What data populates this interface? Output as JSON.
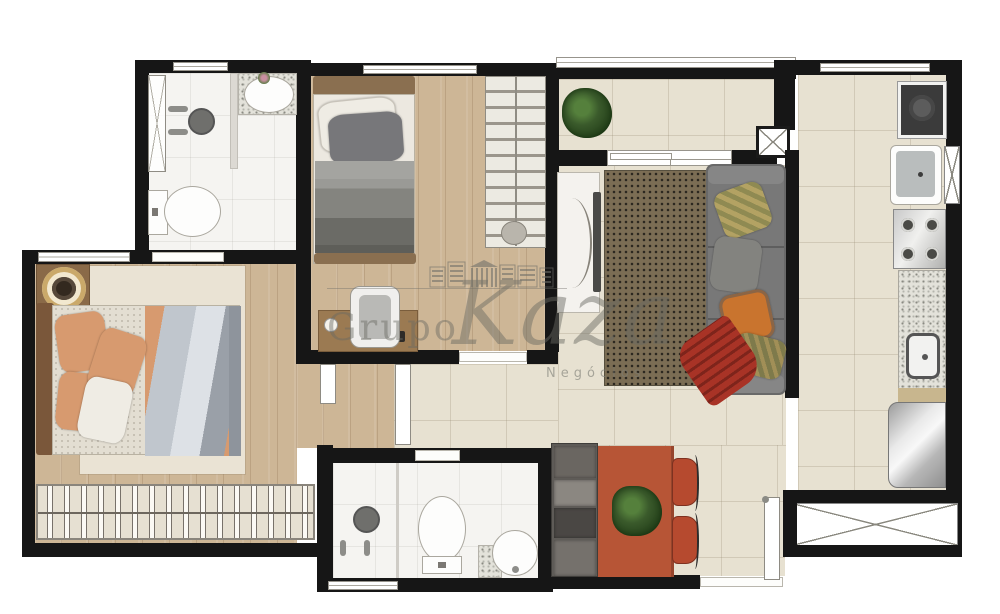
{
  "watermark": {
    "brand_top": "Grupo",
    "brand_main": "Kaza",
    "subtitle": "Negócios"
  },
  "colors": {
    "wall": "#161616",
    "wood": "#cdb696",
    "tile": "#e7e1d1",
    "bath": "#f5f4f1",
    "rugbed": "#eae3d4",
    "ruglive": "#7b6d54",
    "sofa": "#787878",
    "table": "#b75536",
    "chair": "#b64a2f",
    "bench": "#5e5b57",
    "plant": "#3a5a2b",
    "peach": "#d79a6f",
    "pillORG": "#c9742e",
    "throw_red": "#a83326",
    "watermark_gray": "#6e6e68"
  },
  "rooms": [
    {
      "name": "suite-bathroom",
      "furniture": [
        "shower-glass",
        "shower-head",
        "shower-faucets",
        "vanity-sink",
        "toilet"
      ]
    },
    {
      "name": "master-bedroom",
      "furniture": [
        "nightstand",
        "round-lamp",
        "double-bed",
        "area-rug",
        "wardrobe-hangers",
        "top-window"
      ]
    },
    {
      "name": "second-bedroom",
      "furniture": [
        "single-bed",
        "shelf-closet",
        "desk",
        "desk-chair",
        "top-window"
      ]
    },
    {
      "name": "hallway",
      "furniture": [
        "door-leaf-master",
        "door-leaf-bathroom"
      ]
    },
    {
      "name": "social-bathroom",
      "furniture": [
        "shower-head",
        "shower-faucets",
        "toilet",
        "round-sink",
        "bottom-window"
      ]
    },
    {
      "name": "balcony",
      "furniture": [
        "railing",
        "potted-plant",
        "sliding-door"
      ]
    },
    {
      "name": "living-room",
      "furniture": [
        "tv-panel",
        "tv",
        "dotted-rug",
        "sofa",
        "throw-pillows",
        "red-throw"
      ]
    },
    {
      "name": "dining-area",
      "furniture": [
        "bench",
        "dining-table",
        "table-plant",
        "chair",
        "chair",
        "entry-door"
      ]
    },
    {
      "name": "kitchen-laundry",
      "furniture": [
        "washing-machine",
        "laundry-tank",
        "cooktop",
        "granite-counter",
        "kitchen-sink",
        "fridge",
        "service-window"
      ]
    }
  ]
}
